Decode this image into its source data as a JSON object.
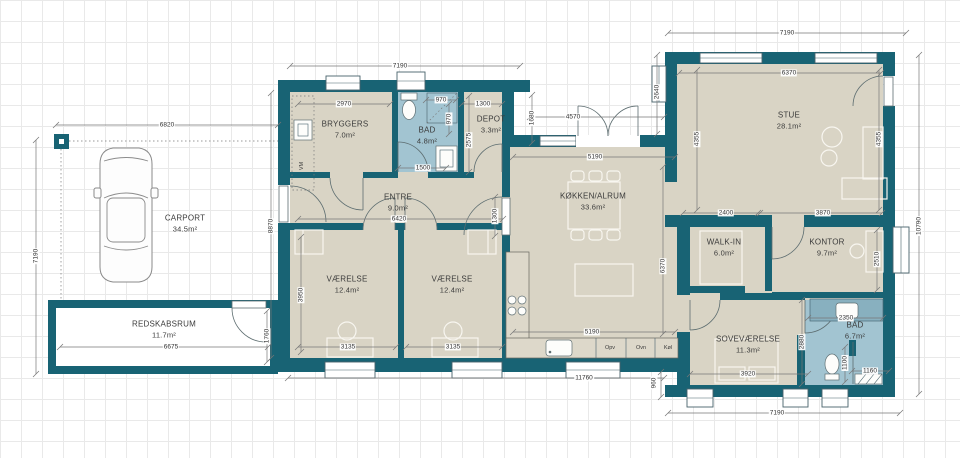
{
  "plan": {
    "rooms": [
      {
        "id": "carport",
        "name": "CARPORT",
        "area": "34.5m²"
      },
      {
        "id": "redskabsrum",
        "name": "REDSKABSRUM",
        "area": "11.7m²"
      },
      {
        "id": "bryggers",
        "name": "BRYGGERS",
        "area": "7.0m²"
      },
      {
        "id": "bad1",
        "name": "BAD",
        "area": "4.8m²"
      },
      {
        "id": "depot",
        "name": "DEPOT",
        "area": "3.3m²"
      },
      {
        "id": "entre",
        "name": "ENTRE",
        "area": "9.0m²"
      },
      {
        "id": "vaerelse1",
        "name": "VÆRELSE",
        "area": "12.4m²"
      },
      {
        "id": "vaerelse2",
        "name": "VÆRELSE",
        "area": "12.4m²"
      },
      {
        "id": "koekken",
        "name": "KØKKEN/ALRUM",
        "area": "33.6m²"
      },
      {
        "id": "stue",
        "name": "STUE",
        "area": "28.1m²"
      },
      {
        "id": "walkin",
        "name": "WALK-IN",
        "area": "6.0m²"
      },
      {
        "id": "kontor",
        "name": "KONTOR",
        "area": "9.7m²"
      },
      {
        "id": "sovevaerelse",
        "name": "SOVEVÆRELSE",
        "area": "11.3m²"
      },
      {
        "id": "bad2",
        "name": "BAD",
        "area": "6.7m²"
      }
    ],
    "dimensions": [
      {
        "id": "tl7190",
        "value": "7190"
      },
      {
        "id": "tr7190",
        "value": "7190"
      },
      {
        "id": "c6820",
        "value": "6820"
      },
      {
        "id": "l7190",
        "value": "7190"
      },
      {
        "id": "l8870",
        "value": "8870"
      },
      {
        "id": "b2970",
        "value": "2970"
      },
      {
        "id": "b970h",
        "value": "970"
      },
      {
        "id": "b970v",
        "value": "970"
      },
      {
        "id": "d1300",
        "value": "1300"
      },
      {
        "id": "d2575",
        "value": "2575"
      },
      {
        "id": "b1500",
        "value": "1500"
      },
      {
        "id": "e6420",
        "value": "6420"
      },
      {
        "id": "v3950",
        "value": "3950"
      },
      {
        "id": "v3135a",
        "value": "3135"
      },
      {
        "id": "v3135b",
        "value": "3135"
      },
      {
        "id": "bot11760",
        "value": "11760"
      },
      {
        "id": "k5190a",
        "value": "5190"
      },
      {
        "id": "k5190b",
        "value": "5190"
      },
      {
        "id": "k6370",
        "value": "6370"
      },
      {
        "id": "t4570",
        "value": "4570"
      },
      {
        "id": "t1680",
        "value": "1680"
      },
      {
        "id": "s2640",
        "value": "2640"
      },
      {
        "id": "s6370",
        "value": "6370"
      },
      {
        "id": "s4355l",
        "value": "4355"
      },
      {
        "id": "s4355r",
        "value": "4355"
      },
      {
        "id": "r10790",
        "value": "10790"
      },
      {
        "id": "w2400",
        "value": "2400"
      },
      {
        "id": "ko3870",
        "value": "3870"
      },
      {
        "id": "ko2510",
        "value": "2510"
      },
      {
        "id": "ba2350",
        "value": "2350"
      },
      {
        "id": "so2880",
        "value": "2880"
      },
      {
        "id": "so3920",
        "value": "3920"
      },
      {
        "id": "ba1100",
        "value": "1100"
      },
      {
        "id": "ba1160",
        "value": "1160"
      },
      {
        "id": "br7190",
        "value": "7190"
      },
      {
        "id": "st960",
        "value": "960"
      },
      {
        "id": "re6675",
        "value": "6675"
      },
      {
        "id": "re1760",
        "value": "1760"
      },
      {
        "id": "ek1300",
        "value": "1300"
      }
    ],
    "appliances": [
      {
        "id": "opv",
        "label": "Opv"
      },
      {
        "id": "ovn",
        "label": "Ovn"
      },
      {
        "id": "koel",
        "label": "Køl"
      },
      {
        "id": "vm",
        "label": "VM"
      }
    ],
    "colors": {
      "wall": "#186374",
      "floor": "#d9d4c5",
      "wet_floor": "#a2c4d1",
      "grid": "#e9e9e9",
      "furniture_line": "#f8f6f0"
    }
  }
}
